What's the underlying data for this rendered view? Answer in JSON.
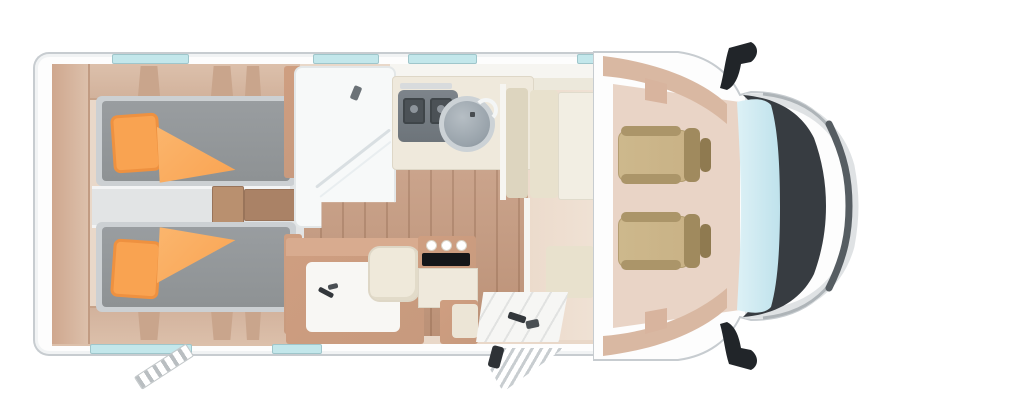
{
  "meta": {
    "title": "Motorhome floor plan (top view)",
    "view": "top-down",
    "text_visible": false
  },
  "palette": {
    "body": "#fdfdfd",
    "outline": "#c7ccd0",
    "wood_light": "#dcc0ab",
    "wood_mid": "#c79a7e",
    "wood_dark": "#b07f63",
    "mattress": "#8e9294",
    "bed_frame": "#ccd0d3",
    "aisle": "#e2e4e5",
    "orange": "#f9a351",
    "shower": "#f7f9f9",
    "counter": "#efe9dc",
    "hob": "#6d747a",
    "sink": "#98a2aa",
    "sink_rim": "#ccd2d6",
    "living_floor": "#ecdbcc",
    "cream": "#e6dfcb",
    "table": "#f2eee3",
    "seat_tan": "#c9b286",
    "seat_tan_dark": "#ab9569",
    "cab_floor": "#e9d4c6",
    "windshield": "#cfe9f1",
    "hood": "#373c41",
    "silver": "#eceeef",
    "window_blue": "#c3e7eb"
  },
  "components": {
    "rear_bedroom": {
      "single_beds": 2,
      "pillows": 2,
      "duvets": 2,
      "center_steps": 2,
      "rear_wardrobe": true
    },
    "bathroom": {
      "shower_cubicle": true,
      "washbasin": true,
      "toilet": true
    },
    "kitchen": {
      "hob_grates": 2,
      "round_sink": true,
      "faucet": true,
      "tall_cabinet": true
    },
    "media": {
      "tv_screen": true,
      "control_knobs": 3
    },
    "dinette": {
      "bench": true,
      "table": true,
      "side_bench": true
    },
    "cab": {
      "swivel_seats": 2,
      "windshield": true,
      "side_mirrors": 2,
      "dark_hood": true
    },
    "exterior": {
      "entry_door_mat": true,
      "entry_step": true,
      "rear_ladder": true,
      "windows_top_wall": 4,
      "windows_bottom_wall": 2
    }
  }
}
